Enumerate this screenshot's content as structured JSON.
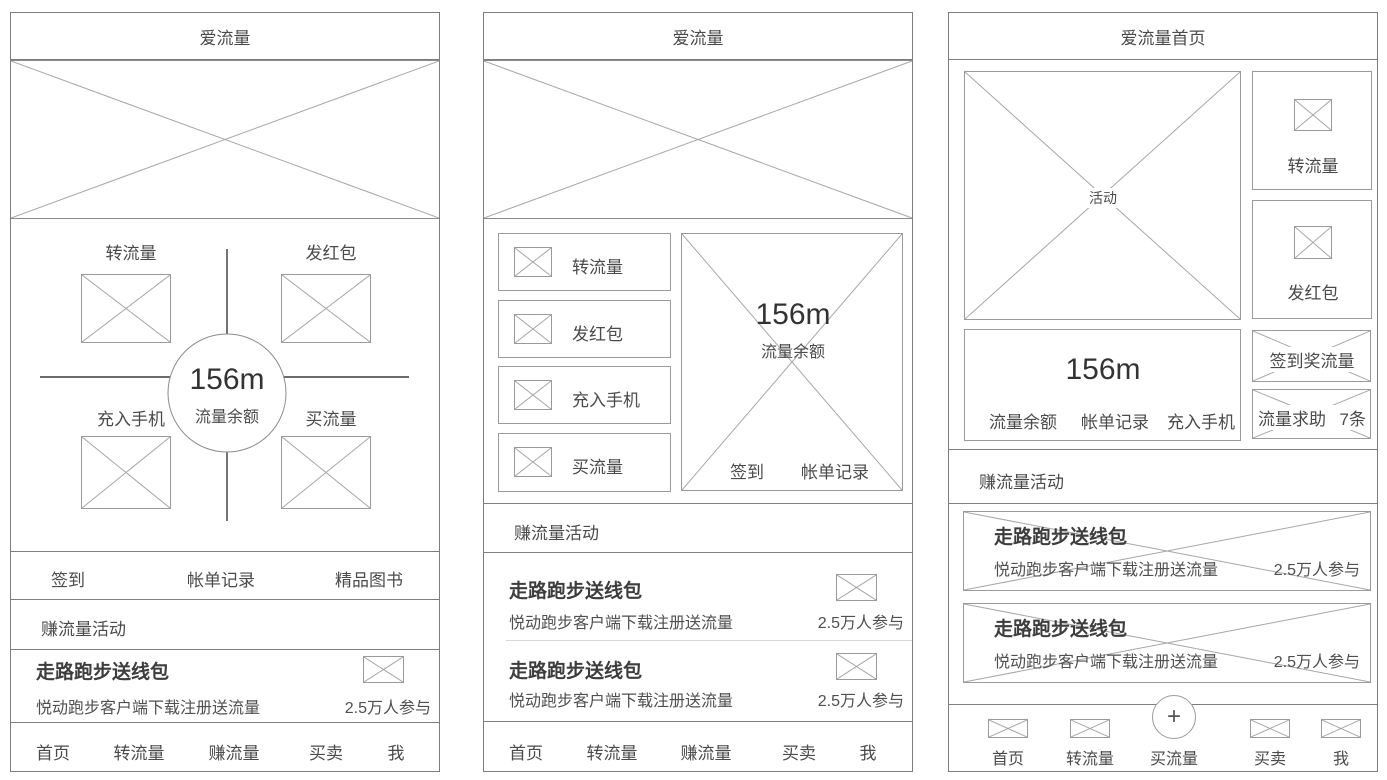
{
  "colors": {
    "panel_border": "#7d7d7d",
    "box_border": "#9b9b9b",
    "placeholder_line": "#a6a6a6",
    "crosshair_line": "#383838",
    "text": "#4a4a4a",
    "divider": "#d8d8d8"
  },
  "panel1": {
    "title": "爱流量",
    "quad": {
      "top_left": "转流量",
      "top_right": "发红包",
      "bottom_left": "充入手机",
      "bottom_right": "买流量",
      "balance_value": "156m",
      "balance_label": "流量余额"
    },
    "quick_links": [
      "签到",
      "帐单记录",
      "精品图书"
    ],
    "section_header": "赚流量活动",
    "activity": {
      "title": "走路跑步送线包",
      "desc": "悦动跑步客户端下载注册送流量",
      "participants": "2.5万人参与"
    },
    "nav": [
      "首页",
      "转流量",
      "赚流量",
      "买卖",
      "我"
    ]
  },
  "panel2": {
    "title": "爱流量",
    "menu": [
      "转流量",
      "发红包",
      "充入手机",
      "买流量"
    ],
    "balance_card": {
      "value": "156m",
      "label": "流量余额",
      "links": [
        "签到",
        "帐单记录"
      ]
    },
    "section_header": "赚流量活动",
    "activities": [
      {
        "title": "走路跑步送线包",
        "desc": "悦动跑步客户端下载注册送流量",
        "participants": "2.5万人参与"
      },
      {
        "title": "走路跑步送线包",
        "desc": "悦动跑步客户端下载注册送流量",
        "participants": "2.5万人参与"
      }
    ],
    "nav": [
      "首页",
      "转流量",
      "赚流量",
      "买卖",
      "我"
    ]
  },
  "panel3": {
    "title": "爱流量首页",
    "banner_label": "活动",
    "side_actions": [
      "转流量",
      "发红包"
    ],
    "balance_card": {
      "value": "156m",
      "links": [
        "流量余额",
        "帐单记录",
        "充入手机"
      ]
    },
    "signin_reward_label": "签到奖流量",
    "help_label": "流量求助",
    "help_count": "7条",
    "section_header": "赚流量活动",
    "activities": [
      {
        "title": "走路跑步送线包",
        "desc": "悦动跑步客户端下载注册送流量",
        "participants": "2.5万人参与"
      },
      {
        "title": "走路跑步送线包",
        "desc": "悦动跑步客户端下载注册送流量",
        "participants": "2.5万人参与"
      }
    ],
    "nav": [
      "首页",
      "转流量",
      "买流量",
      "买卖",
      "我"
    ],
    "fab_label": "+"
  }
}
